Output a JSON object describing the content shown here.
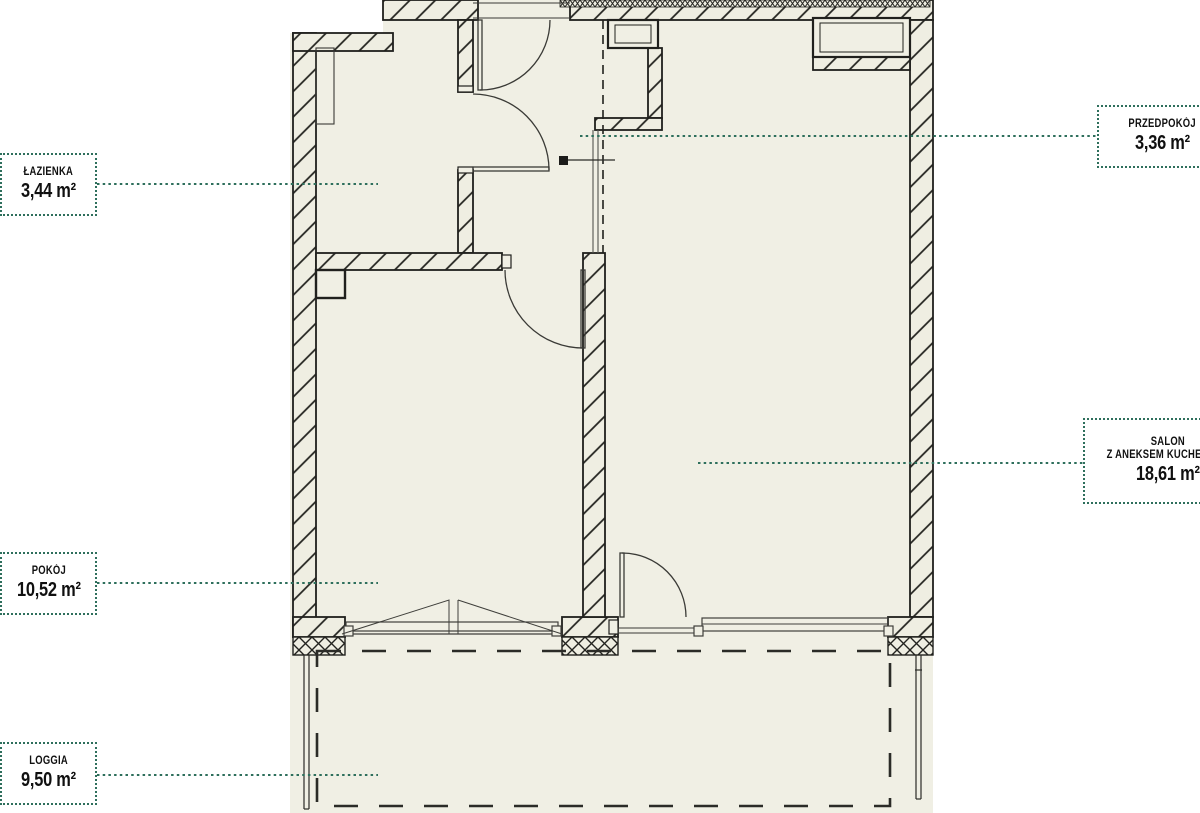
{
  "colors": {
    "paper": "#f0efe4",
    "ink": "#20201d",
    "leader": "#2e6f5c",
    "white": "#ffffff"
  },
  "rooms": {
    "lazienka": {
      "name": "ŁAZIENKA",
      "area": "3,44 m²"
    },
    "przedpokoj": {
      "name": "PRZEDPOKÓJ",
      "area": "3,36 m²"
    },
    "salon": {
      "name": "SALON",
      "subname": "Z ANEKSEM KUCHENNYM",
      "area": "18,61 m²"
    },
    "pokoj": {
      "name": "POKÓJ",
      "area": "10,52 m²"
    },
    "loggia": {
      "name": "LOGGIA",
      "area": "9,50 m²"
    }
  }
}
